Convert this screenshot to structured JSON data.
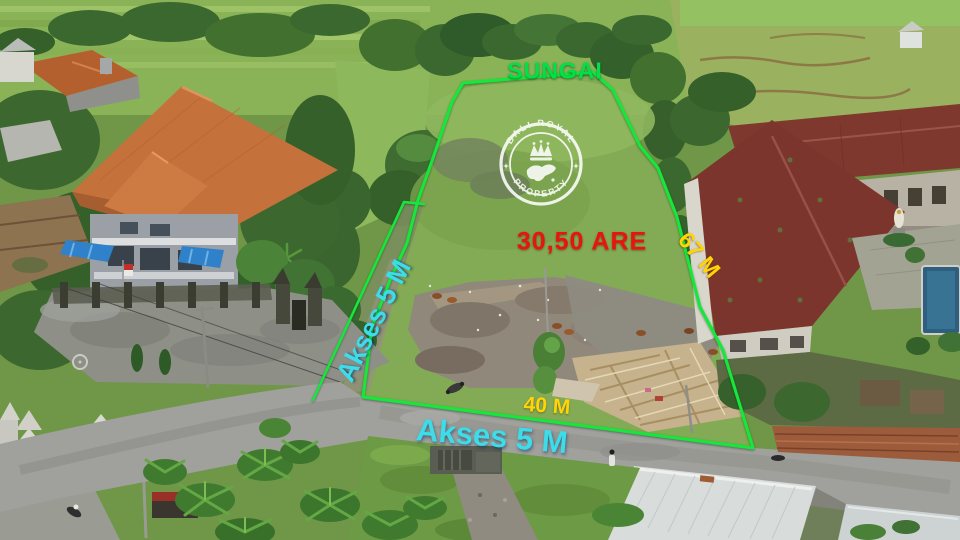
{
  "labels": {
    "river": "SUNGAI",
    "area": "30,50 ARE",
    "side_length": "67 M",
    "road_width_front": "40 M",
    "access_left": "Akses 5 M",
    "access_front": "Akses 5 M"
  },
  "watermark": {
    "arc_top": "BALI ROYAL",
    "arc_bottom": "PROPERTY",
    "icon": "crown-over-bali-island"
  },
  "colors": {
    "boundary_line": "#12e73a",
    "river_label": "#00e04a",
    "area_label": "#e8150c",
    "length_labels": "#ffd409",
    "access_labels": "#3cdde9",
    "watermark": "#ffffff"
  }
}
